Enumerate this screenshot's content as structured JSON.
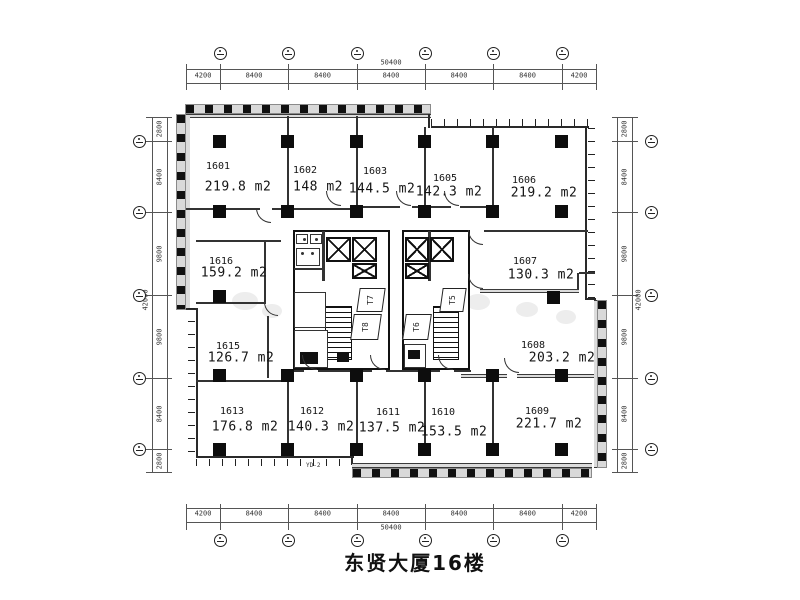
{
  "title": "东贤大厦16楼",
  "rooms": [
    {
      "number": "1601",
      "area": "219.8 m2"
    },
    {
      "number": "1602",
      "area": "148 m2"
    },
    {
      "number": "1603",
      "area": "144.5 m2"
    },
    {
      "number": "1605",
      "area": "142.3 m2"
    },
    {
      "number": "1606",
      "area": "219.2 m2"
    },
    {
      "number": "1607",
      "area": "130.3 m2"
    },
    {
      "number": "1608",
      "area": "203.2 m2"
    },
    {
      "number": "1609",
      "area": "221.7 m2"
    },
    {
      "number": "1610",
      "area": "153.5 m2"
    },
    {
      "number": "1611",
      "area": "137.5 m2"
    },
    {
      "number": "1612",
      "area": "140.3 m2"
    },
    {
      "number": "1613",
      "area": "176.8 m2"
    },
    {
      "number": "1615",
      "area": "126.7 m2"
    },
    {
      "number": "1616",
      "area": "159.2 m2"
    }
  ],
  "core_labels": [
    "T7",
    "T8",
    "T5",
    "T6"
  ],
  "wall_label": "YD-2",
  "dimensions": {
    "top": {
      "total": "50400",
      "segments": [
        "4200",
        "8400",
        "8400",
        "8400",
        "8400",
        "8400",
        "4200"
      ]
    },
    "bottom": {
      "total": "50400",
      "segments": [
        "4200",
        "8400",
        "8400",
        "8400",
        "8400",
        "8400",
        "4200"
      ]
    },
    "left": {
      "total": "42000",
      "segments": [
        "2800",
        "8400",
        "9800",
        "9800",
        "8400",
        "2800"
      ]
    },
    "right": {
      "total": "42000",
      "segments": [
        "2800",
        "8400",
        "9800",
        "9800",
        "8400",
        "2800"
      ]
    }
  },
  "colors": {
    "wall": "#1a1a1a",
    "thin_line": "#444",
    "dimension_text": "#333",
    "facade_band": "#d9d9d9",
    "background": "#ffffff"
  }
}
